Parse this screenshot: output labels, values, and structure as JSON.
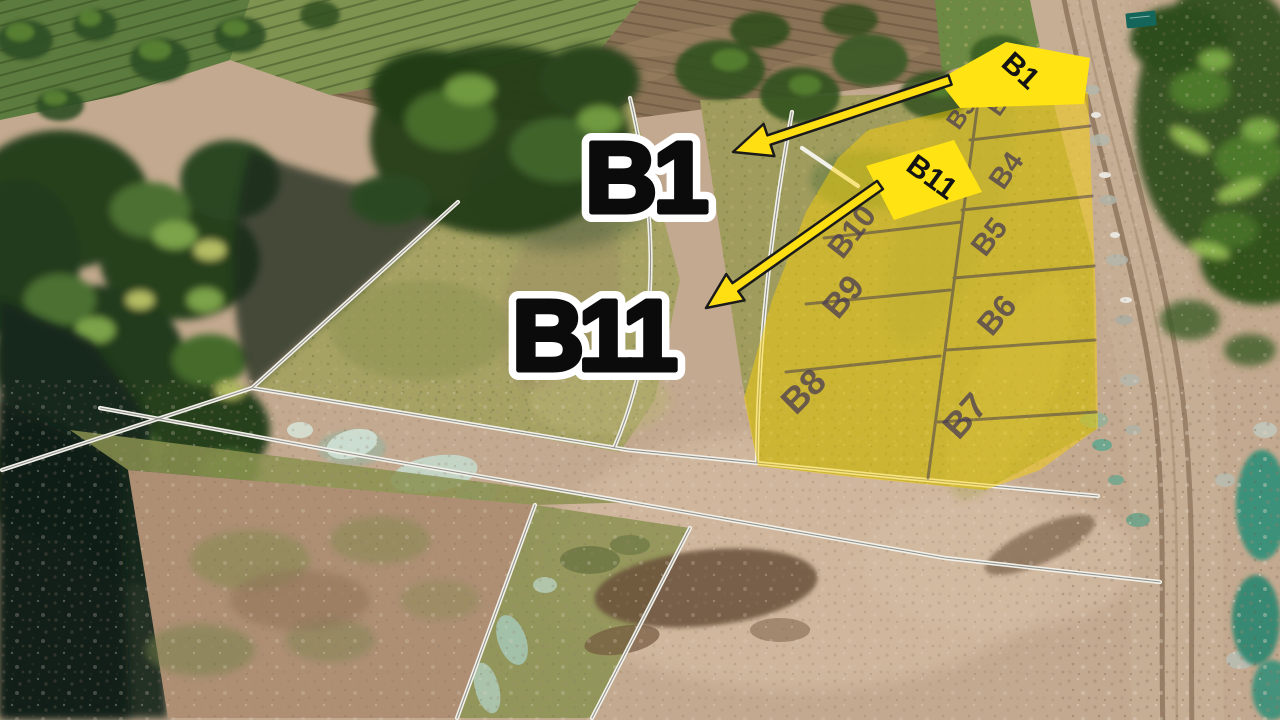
{
  "callouts": {
    "b1": {
      "label": "B1"
    },
    "b11": {
      "label": "B11"
    }
  },
  "signs": {
    "b1": {
      "label": "B1"
    },
    "b11": {
      "label": "B11"
    }
  },
  "overlay": {
    "plots": [
      {
        "label": "B2"
      },
      {
        "label": "B3"
      },
      {
        "label": "B4"
      },
      {
        "label": "B5"
      },
      {
        "label": "B6"
      },
      {
        "label": "B7"
      },
      {
        "label": "B8"
      },
      {
        "label": "B9"
      },
      {
        "label": "B10"
      }
    ]
  },
  "colors": {
    "highlight_yellow": "#ffdf12",
    "overlay_yellow": "#ffd400",
    "callout_text": "#0b0b0b",
    "callout_outline": "#ffffff",
    "plot_label": "#443754",
    "boundary_line": "#f2f1ea",
    "teal_patch": "#2f8f78"
  }
}
